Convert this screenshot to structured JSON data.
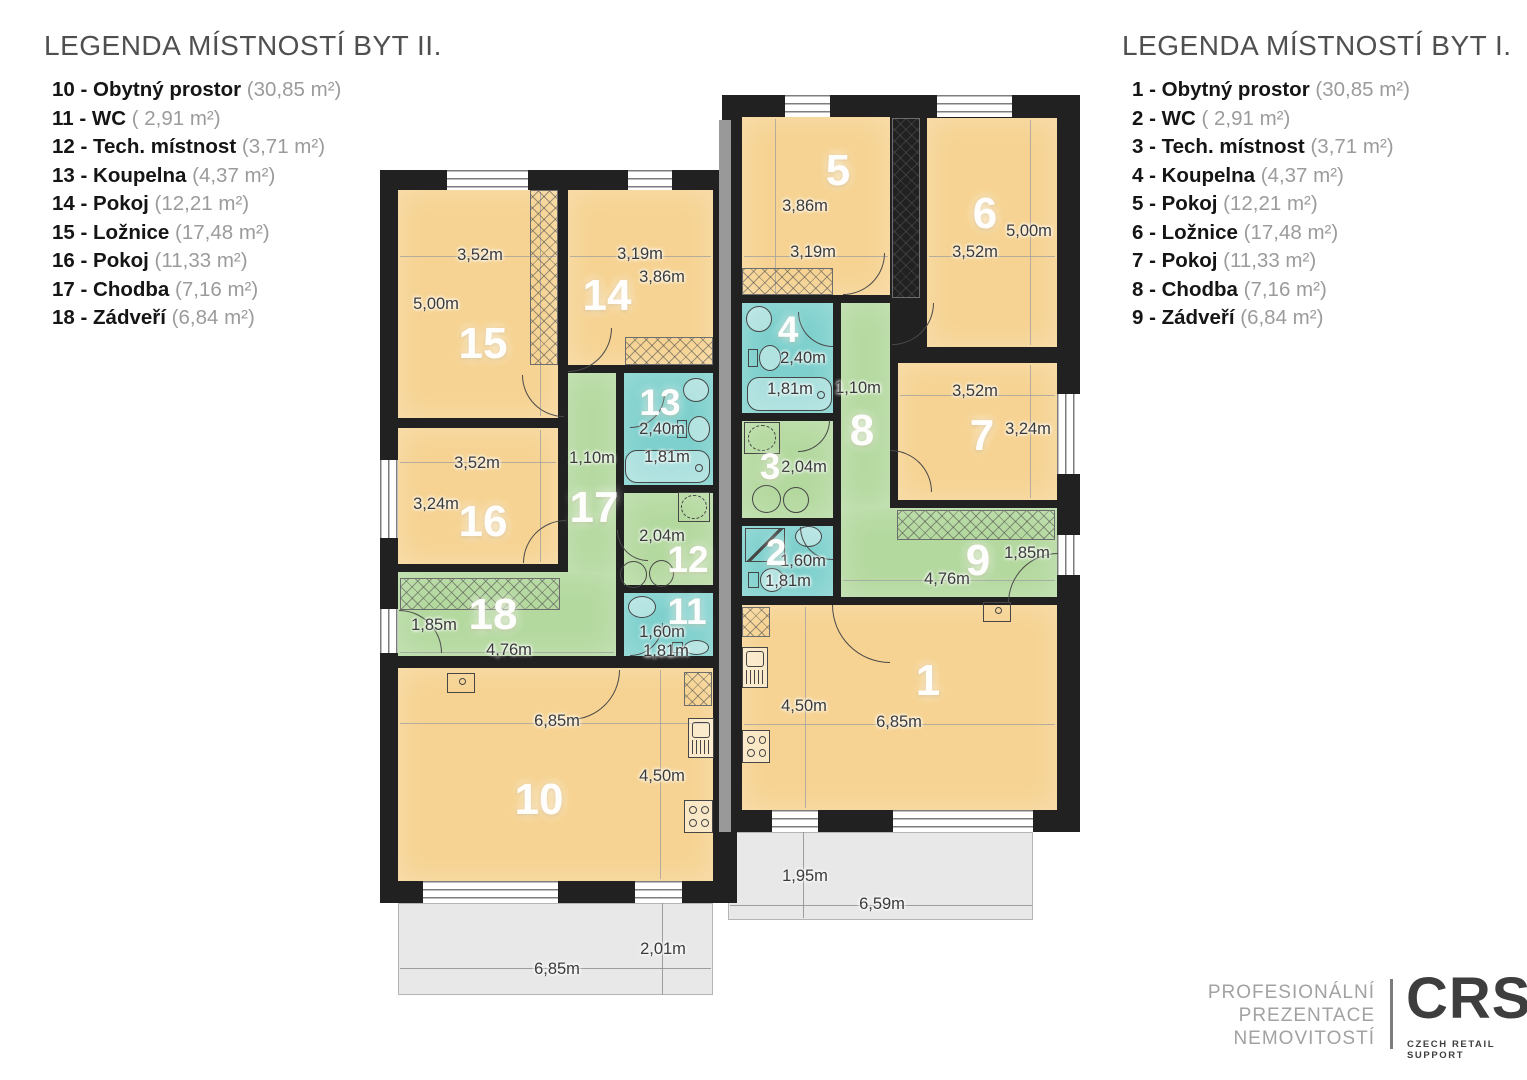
{
  "legend_left": {
    "title": "LEGENDA MÍSTNOSTÍ BYT II.",
    "items": [
      {
        "label": "10 - Obytný prostor",
        "area": "(30,85 m²)"
      },
      {
        "label": "11 - WC",
        "area": "( 2,91 m²)"
      },
      {
        "label": "12 - Tech. místnost",
        "area": "(3,71 m²)"
      },
      {
        "label": "13 - Koupelna",
        "area": "(4,37 m²)"
      },
      {
        "label": "14 - Pokoj",
        "area": "(12,21 m²)"
      },
      {
        "label": "15 - Ložnice",
        "area": "(17,48 m²)"
      },
      {
        "label": "16 - Pokoj",
        "area": "(11,33 m²)"
      },
      {
        "label": "17 - Chodba",
        "area": "(7,16 m²)"
      },
      {
        "label": "18 - Zádveří",
        "area": "(6,84 m²)"
      }
    ]
  },
  "legend_right": {
    "title": "LEGENDA MÍSTNOSTÍ BYT I.",
    "items": [
      {
        "label": "1 - Obytný prostor",
        "area": "(30,85 m²)"
      },
      {
        "label": "2 - WC",
        "area": "( 2,91 m²)"
      },
      {
        "label": "3 - Tech. místnost",
        "area": "(3,71 m²)"
      },
      {
        "label": "4 - Koupelna",
        "area": "(4,37 m²)"
      },
      {
        "label": "5 - Pokoj",
        "area": "(12,21 m²)"
      },
      {
        "label": "6 - Ložnice",
        "area": "(17,48 m²)"
      },
      {
        "label": "7 - Pokoj",
        "area": "(11,33 m²)"
      },
      {
        "label": "8 - Chodba",
        "area": "(7,16 m²)"
      },
      {
        "label": "9 - Zádveří",
        "area": "(6,84 m²)"
      }
    ]
  },
  "colors": {
    "wall": "#212121",
    "room": "#f6d392",
    "corridor": "#b4d99f",
    "wet": "#7dd0cd",
    "terrace": "#e8e8e8",
    "stripe": "#999999"
  },
  "plan": {
    "slabs": [
      {
        "x": 380,
        "y": 170,
        "w": 357,
        "h": 733
      },
      {
        "x": 722,
        "y": 95,
        "w": 358,
        "h": 737
      }
    ],
    "party_stripe": {
      "x": 719,
      "y": 120,
      "w": 12,
      "h": 712
    },
    "terraces": [
      {
        "name": "terrace-left",
        "x": 398,
        "y": 903,
        "w": 315,
        "h": 92,
        "dims": [
          {
            "t": "2,01m",
            "x": 663,
            "y": 950
          },
          {
            "t": "6,85m",
            "x": 557,
            "y": 970
          }
        ],
        "lines": [
          {
            "x": 400,
            "y": 968,
            "w": 311,
            "h": 1
          },
          {
            "x": 662,
            "y": 903,
            "w": 1,
            "h": 92
          }
        ]
      },
      {
        "name": "terrace-right",
        "x": 728,
        "y": 832,
        "w": 305,
        "h": 88,
        "dims": [
          {
            "t": "1,95m",
            "x": 805,
            "y": 877
          },
          {
            "t": "6,59m",
            "x": 882,
            "y": 905
          }
        ],
        "lines": [
          {
            "x": 730,
            "y": 905,
            "w": 302,
            "h": 1
          },
          {
            "x": 803,
            "y": 832,
            "w": 1,
            "h": 86
          }
        ]
      }
    ],
    "rooms": [
      {
        "num": "15",
        "type": "room",
        "x": 398,
        "y": 190,
        "w": 160,
        "h": 228,
        "nx": 483,
        "ny": 345,
        "ns": "lg",
        "dims": [
          {
            "t": "3,52m",
            "x": 480,
            "y": 256
          },
          {
            "t": "5,00m",
            "x": 436,
            "y": 305
          }
        ]
      },
      {
        "num": "14",
        "type": "room",
        "x": 568,
        "y": 190,
        "w": 145,
        "h": 175,
        "nx": 607,
        "ny": 297,
        "ns": "lg",
        "dims": [
          {
            "t": "3,19m",
            "x": 640,
            "y": 255
          },
          {
            "t": "3,86m",
            "x": 662,
            "y": 278
          }
        ]
      },
      {
        "num": "13",
        "type": "wet",
        "x": 624,
        "y": 373,
        "w": 89,
        "h": 112,
        "nx": 660,
        "ny": 403,
        "ns": "sm",
        "dims": [
          {
            "t": "2,40m",
            "x": 662,
            "y": 430
          },
          {
            "t": "1,81m",
            "x": 667,
            "y": 458
          }
        ]
      },
      {
        "num": "17",
        "type": "corridor",
        "x": 568,
        "y": 373,
        "w": 48,
        "h": 205,
        "nx": 594,
        "ny": 509,
        "ns": "lg",
        "dims": [
          {
            "t": "1,10m",
            "x": 592,
            "y": 459
          }
        ]
      },
      {
        "num": "16",
        "type": "room",
        "x": 398,
        "y": 428,
        "w": 160,
        "h": 136,
        "nx": 483,
        "ny": 523,
        "ns": "lg",
        "dims": [
          {
            "t": "3,52m",
            "x": 477,
            "y": 464
          },
          {
            "t": "3,24m",
            "x": 436,
            "y": 505
          }
        ]
      },
      {
        "num": "12",
        "type": "corridor",
        "x": 624,
        "y": 493,
        "w": 89,
        "h": 92,
        "nx": 688,
        "ny": 560,
        "ns": "sm",
        "dims": [
          {
            "t": "2,04m",
            "x": 662,
            "y": 537
          }
        ]
      },
      {
        "num": "18",
        "type": "corridor",
        "x": 398,
        "y": 572,
        "w": 218,
        "h": 84,
        "nx": 493,
        "ny": 616,
        "ns": "lg",
        "dims": [
          {
            "t": "1,85m",
            "x": 434,
            "y": 626
          },
          {
            "t": "4,76m",
            "x": 509,
            "y": 651
          }
        ]
      },
      {
        "num": "11",
        "type": "wet",
        "x": 624,
        "y": 593,
        "w": 89,
        "h": 63,
        "nx": 687,
        "ny": 612,
        "ns": "sm",
        "dims": [
          {
            "t": "1,60m",
            "x": 662,
            "y": 633
          },
          {
            "t": "1,81m",
            "x": 666,
            "y": 652
          }
        ]
      },
      {
        "num": "10",
        "type": "room",
        "x": 398,
        "y": 668,
        "w": 315,
        "h": 213,
        "nx": 539,
        "ny": 801,
        "ns": "lg",
        "dims": [
          {
            "t": "6,85m",
            "x": 557,
            "y": 722
          },
          {
            "t": "4,50m",
            "x": 662,
            "y": 777
          }
        ]
      },
      {
        "num": "5",
        "type": "room",
        "x": 742,
        "y": 117,
        "w": 148,
        "h": 178,
        "nx": 838,
        "ny": 172,
        "ns": "lg",
        "dims": [
          {
            "t": "3,86m",
            "x": 805,
            "y": 207
          },
          {
            "t": "3,19m",
            "x": 813,
            "y": 253
          }
        ]
      },
      {
        "num": "6",
        "type": "room",
        "x": 927,
        "y": 118,
        "w": 130,
        "h": 229,
        "nx": 985,
        "ny": 215,
        "ns": "lg",
        "dims": [
          {
            "t": "3,52m",
            "x": 975,
            "y": 253
          },
          {
            "t": "5,00m",
            "x": 1029,
            "y": 232
          }
        ]
      },
      {
        "num": "4",
        "type": "wet",
        "x": 742,
        "y": 303,
        "w": 91,
        "h": 110,
        "nx": 788,
        "ny": 330,
        "ns": "sm",
        "dims": [
          {
            "t": "2,40m",
            "x": 803,
            "y": 359
          },
          {
            "t": "1,81m",
            "x": 790,
            "y": 390
          }
        ]
      },
      {
        "num": "8",
        "type": "corridor",
        "x": 841,
        "y": 303,
        "w": 49,
        "h": 205,
        "nx": 862,
        "ny": 432,
        "ns": "lg",
        "dims": [
          {
            "t": "1,10m",
            "x": 858,
            "y": 389
          }
        ]
      },
      {
        "num": "7",
        "type": "room",
        "x": 898,
        "y": 363,
        "w": 159,
        "h": 137,
        "nx": 982,
        "ny": 437,
        "ns": "lg",
        "dims": [
          {
            "t": "3,52m",
            "x": 975,
            "y": 392
          },
          {
            "t": "3,24m",
            "x": 1028,
            "y": 430
          }
        ]
      },
      {
        "num": "3",
        "type": "corridor",
        "x": 742,
        "y": 421,
        "w": 91,
        "h": 97,
        "nx": 770,
        "ny": 467,
        "ns": "sm",
        "dims": [
          {
            "t": "2,04m",
            "x": 804,
            "y": 468
          }
        ]
      },
      {
        "num": "9",
        "type": "corridor",
        "x": 841,
        "y": 508,
        "w": 216,
        "h": 89,
        "nx": 978,
        "ny": 562,
        "ns": "lg",
        "dims": [
          {
            "t": "1,85m",
            "x": 1027,
            "y": 554
          },
          {
            "t": "4,76m",
            "x": 947,
            "y": 580
          }
        ]
      },
      {
        "num": "2",
        "type": "wet",
        "x": 742,
        "y": 526,
        "w": 91,
        "h": 70,
        "nx": 776,
        "ny": 553,
        "ns": "sm",
        "dims": [
          {
            "t": "1,60m",
            "x": 803,
            "y": 562
          },
          {
            "t": "1,81m",
            "x": 788,
            "y": 582
          }
        ]
      },
      {
        "num": "1",
        "type": "room",
        "x": 742,
        "y": 605,
        "w": 315,
        "h": 205,
        "nx": 928,
        "ny": 682,
        "ns": "lg",
        "dims": [
          {
            "t": "4,50m",
            "x": 804,
            "y": 707
          },
          {
            "t": "6,85m",
            "x": 899,
            "y": 723
          }
        ]
      }
    ],
    "windows": [
      {
        "x": 447,
        "y": 170,
        "w": 81,
        "h": 20
      },
      {
        "x": 628,
        "y": 170,
        "w": 44,
        "h": 20
      },
      {
        "x": 380,
        "y": 460,
        "w": 18,
        "h": 78
      },
      {
        "x": 380,
        "y": 609,
        "w": 18,
        "h": 44
      },
      {
        "x": 423,
        "y": 881,
        "w": 135,
        "h": 22
      },
      {
        "x": 635,
        "y": 881,
        "w": 47,
        "h": 22
      },
      {
        "x": 785,
        "y": 95,
        "w": 45,
        "h": 22
      },
      {
        "x": 937,
        "y": 95,
        "w": 75,
        "h": 22
      },
      {
        "x": 1057,
        "y": 394,
        "w": 23,
        "h": 80
      },
      {
        "x": 1057,
        "y": 535,
        "w": 23,
        "h": 40
      },
      {
        "x": 772,
        "y": 810,
        "w": 46,
        "h": 22
      },
      {
        "x": 893,
        "y": 810,
        "w": 140,
        "h": 22
      }
    ],
    "doors": [
      {
        "x": 399,
        "y": 610,
        "r": 43,
        "c": "tr"
      },
      {
        "x": 570,
        "y": 670,
        "r": 50,
        "c": "br"
      },
      {
        "x": 523,
        "y": 520,
        "r": 43,
        "c": "tl"
      },
      {
        "x": 522,
        "y": 375,
        "r": 42,
        "c": "bl"
      },
      {
        "x": 568,
        "y": 328,
        "r": 44,
        "c": "br"
      },
      {
        "x": 630,
        "y": 393,
        "r": 35,
        "c": "br"
      },
      {
        "x": 630,
        "y": 623,
        "r": 33,
        "c": "br"
      },
      {
        "x": 617,
        "y": 530,
        "r": 31,
        "c": "bl"
      },
      {
        "x": 832,
        "y": 605,
        "r": 58,
        "c": "bl"
      },
      {
        "x": 1008,
        "y": 553,
        "r": 50,
        "c": "tl"
      },
      {
        "x": 798,
        "y": 312,
        "r": 35,
        "c": "bl"
      },
      {
        "x": 800,
        "y": 527,
        "r": 33,
        "c": "bl"
      },
      {
        "x": 798,
        "y": 420,
        "r": 32,
        "c": "br"
      },
      {
        "x": 890,
        "y": 450,
        "r": 42,
        "c": "tr"
      },
      {
        "x": 892,
        "y": 303,
        "r": 42,
        "c": "br"
      },
      {
        "x": 843,
        "y": 253,
        "r": 42,
        "c": "br"
      }
    ],
    "wardrobes": [
      {
        "x": 530,
        "y": 190,
        "w": 28,
        "h": 175
      },
      {
        "x": 892,
        "y": 118,
        "w": 28,
        "h": 180
      },
      {
        "x": 742,
        "y": 268,
        "w": 91,
        "h": 27
      },
      {
        "x": 400,
        "y": 578,
        "w": 160,
        "h": 32
      },
      {
        "x": 897,
        "y": 510,
        "w": 158,
        "h": 30
      },
      {
        "x": 625,
        "y": 337,
        "w": 88,
        "h": 28
      },
      {
        "x": 742,
        "y": 607,
        "w": 28,
        "h": 30
      },
      {
        "x": 684,
        "y": 672,
        "w": 28,
        "h": 34
      }
    ],
    "fixtures": [
      {
        "icon": "bathtub-icon",
        "x": 625,
        "y": 450,
        "w": 85,
        "h": 33
      },
      {
        "icon": "washbasin-icon",
        "x": 683,
        "y": 378,
        "w": 26,
        "h": 24
      },
      {
        "icon": "toilet-icon",
        "x": 677,
        "y": 416,
        "w": 34,
        "h": 26
      },
      {
        "icon": "washbasin-icon",
        "x": 746,
        "y": 306,
        "w": 26,
        "h": 26
      },
      {
        "icon": "toilet-icon",
        "x": 748,
        "y": 345,
        "w": 34,
        "h": 26
      },
      {
        "icon": "bathtub-icon",
        "x": 747,
        "y": 377,
        "w": 85,
        "h": 34
      },
      {
        "icon": "washbasin-icon",
        "x": 628,
        "y": 596,
        "w": 28,
        "h": 22
      },
      {
        "icon": "toilet-icon",
        "x": 672,
        "y": 640,
        "w": 38,
        "h": 15
      },
      {
        "icon": "shower-icon",
        "x": 745,
        "y": 528,
        "w": 40,
        "h": 34
      },
      {
        "icon": "washbasin-icon",
        "x": 795,
        "y": 526,
        "w": 27,
        "h": 21
      },
      {
        "icon": "toilet-icon",
        "x": 748,
        "y": 568,
        "w": 37,
        "h": 24
      },
      {
        "icon": "washer-icon",
        "x": 620,
        "y": 561,
        "w": 27,
        "h": 27
      },
      {
        "icon": "washer-icon",
        "x": 649,
        "y": 560,
        "w": 25,
        "h": 27
      },
      {
        "icon": "boiler-icon",
        "x": 678,
        "y": 492,
        "w": 32,
        "h": 30
      },
      {
        "icon": "boiler-icon",
        "x": 744,
        "y": 422,
        "w": 36,
        "h": 32
      },
      {
        "icon": "washer-icon",
        "x": 752,
        "y": 485,
        "w": 29,
        "h": 28
      },
      {
        "icon": "washer-icon",
        "x": 783,
        "y": 487,
        "w": 26,
        "h": 26
      },
      {
        "icon": "sink-icon",
        "x": 688,
        "y": 718,
        "w": 26,
        "h": 40
      },
      {
        "icon": "stove-icon",
        "x": 684,
        "y": 800,
        "w": 29,
        "h": 33
      },
      {
        "icon": "sink-icon",
        "x": 742,
        "y": 647,
        "w": 26,
        "h": 41
      },
      {
        "icon": "stove-icon",
        "x": 742,
        "y": 730,
        "w": 28,
        "h": 33
      },
      {
        "icon": "cabinet-icon",
        "x": 447,
        "y": 673,
        "w": 28,
        "h": 20
      },
      {
        "icon": "cabinet-icon",
        "x": 983,
        "y": 602,
        "w": 28,
        "h": 20
      }
    ],
    "hairlines": [
      {
        "x": 400,
        "y": 256,
        "w": 156,
        "h": 1
      },
      {
        "x": 540,
        "y": 192,
        "w": 1,
        "h": 224
      },
      {
        "x": 570,
        "y": 256,
        "w": 141,
        "h": 1
      },
      {
        "x": 400,
        "y": 462,
        "w": 156,
        "h": 1
      },
      {
        "x": 540,
        "y": 430,
        "w": 1,
        "h": 132
      },
      {
        "x": 400,
        "y": 723,
        "w": 310,
        "h": 1
      },
      {
        "x": 660,
        "y": 670,
        "w": 1,
        "h": 209
      },
      {
        "x": 400,
        "y": 652,
        "w": 214,
        "h": 1
      },
      {
        "x": 744,
        "y": 256,
        "w": 144,
        "h": 1
      },
      {
        "x": 775,
        "y": 119,
        "w": 1,
        "h": 174
      },
      {
        "x": 929,
        "y": 256,
        "w": 126,
        "h": 1
      },
      {
        "x": 1030,
        "y": 120,
        "w": 1,
        "h": 225
      },
      {
        "x": 900,
        "y": 395,
        "w": 155,
        "h": 1
      },
      {
        "x": 1030,
        "y": 365,
        "w": 1,
        "h": 133
      },
      {
        "x": 843,
        "y": 580,
        "w": 212,
        "h": 1
      },
      {
        "x": 744,
        "y": 724,
        "w": 311,
        "h": 1
      },
      {
        "x": 805,
        "y": 607,
        "w": 1,
        "h": 201
      }
    ]
  },
  "footer": {
    "lines": [
      "PROFESIONÁLNÍ",
      "PREZENTACE",
      "NEMOVITOSTÍ"
    ],
    "logo": "CRS",
    "tagline": "CZECH RETAIL SUPPORT"
  }
}
